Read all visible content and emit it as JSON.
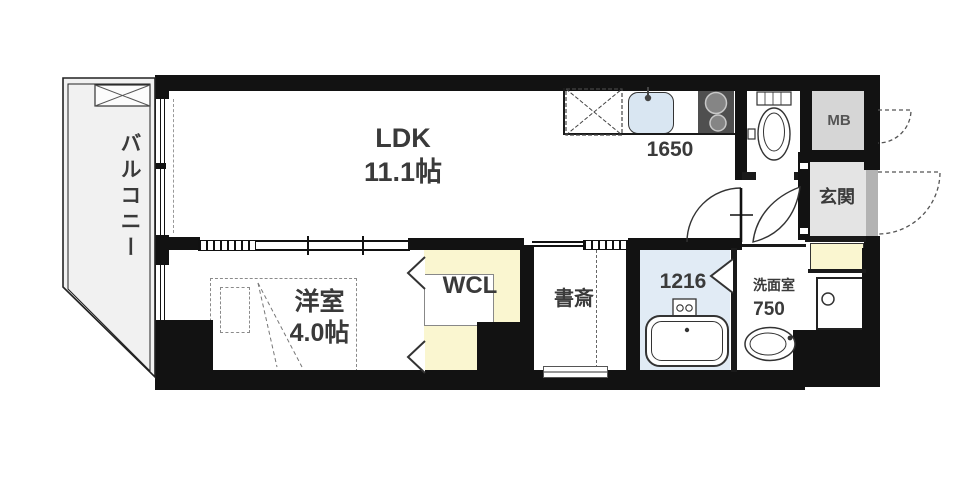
{
  "title": "apartment-floor-plan",
  "rooms": {
    "balcony": {
      "label": "バルコニー"
    },
    "ldk": {
      "label": "LDK",
      "size": "11.1帖"
    },
    "kitchen": {
      "counter_width": "1650"
    },
    "meter_box": {
      "label": "MB"
    },
    "entrance": {
      "label": "玄関"
    },
    "western_room": {
      "label": "洋室",
      "size": "4.0帖"
    },
    "walk_in_closet": {
      "label": "WCL"
    },
    "study": {
      "label": "書斎"
    },
    "bathroom": {
      "unit_size": "1216"
    },
    "washroom": {
      "label": "洗面室",
      "width": "750"
    }
  },
  "fixtures": [
    "evacuation-hatch",
    "refrigerator-space",
    "kitchen-sink",
    "gas-stove",
    "toilet",
    "bathtub",
    "shower-mixer",
    "washbasin",
    "washing-machine-pan"
  ],
  "colors": {
    "wall": "#121212",
    "balcony_fill": "#f1f1f1",
    "meter_box_fill": "#d6d6d6",
    "entrance_fill": "#e4e4e4",
    "closet_fill": "#faf6d0",
    "bathroom_fill": "#e1ebf5",
    "sink_fill": "#d9e6f2",
    "stove_fill": "#4f4f4f",
    "door_slab": "#b3b3b3",
    "text": "#3a3a3a"
  }
}
